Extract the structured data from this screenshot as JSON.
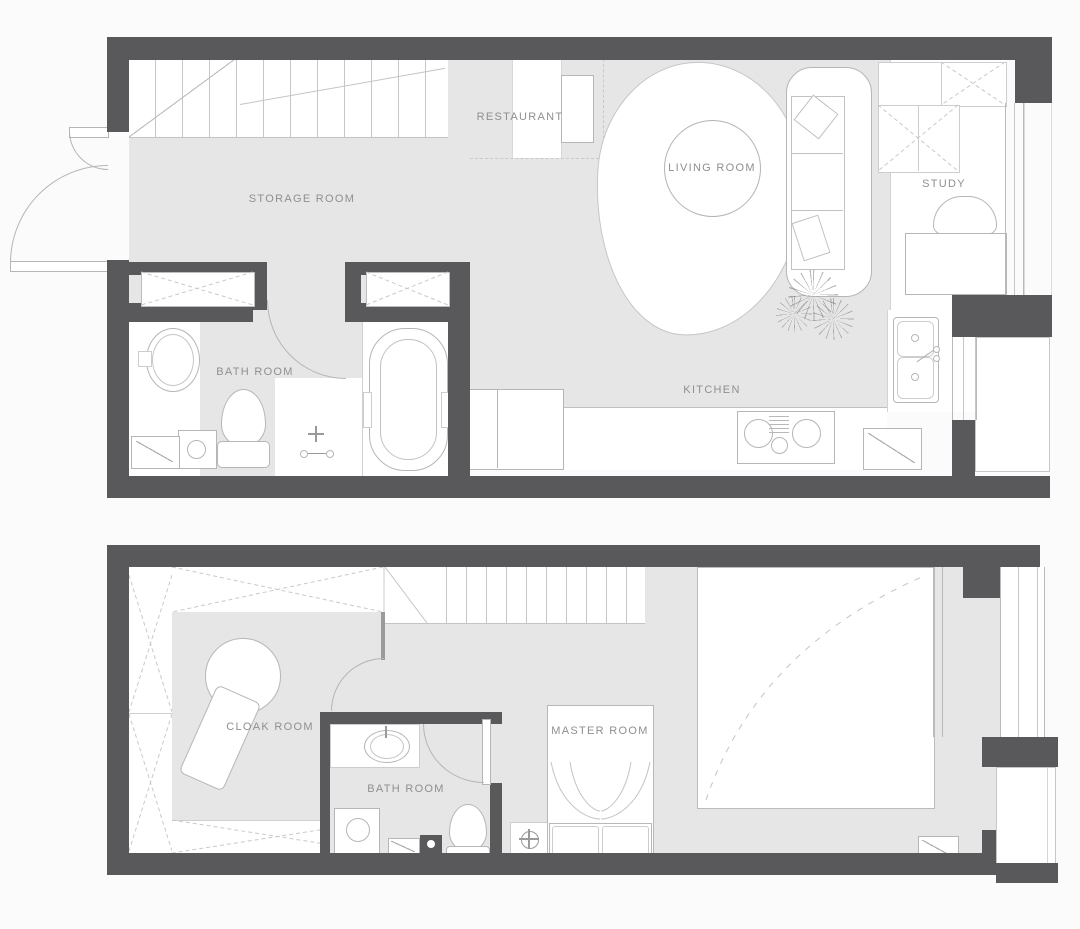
{
  "palette": {
    "wall": "#59595b",
    "floor": "#e6e6e7",
    "line": "#b6b6b6",
    "text": "#8f8f8f",
    "bg": "#fbfbfb"
  },
  "floor1": {
    "name": "First floor plan",
    "labels": {
      "restaurant": "RESTAURANT",
      "storage": "STORAGE ROOM",
      "living": "LIVING ROOM",
      "study": "STUDY",
      "bath": "BATH ROOM",
      "kitchen": "KITCHEN"
    }
  },
  "floor2": {
    "name": "Second floor plan",
    "labels": {
      "cloak": "CLOAK ROOM",
      "bath": "BATH ROOM",
      "master": "MASTER ROOM"
    }
  }
}
